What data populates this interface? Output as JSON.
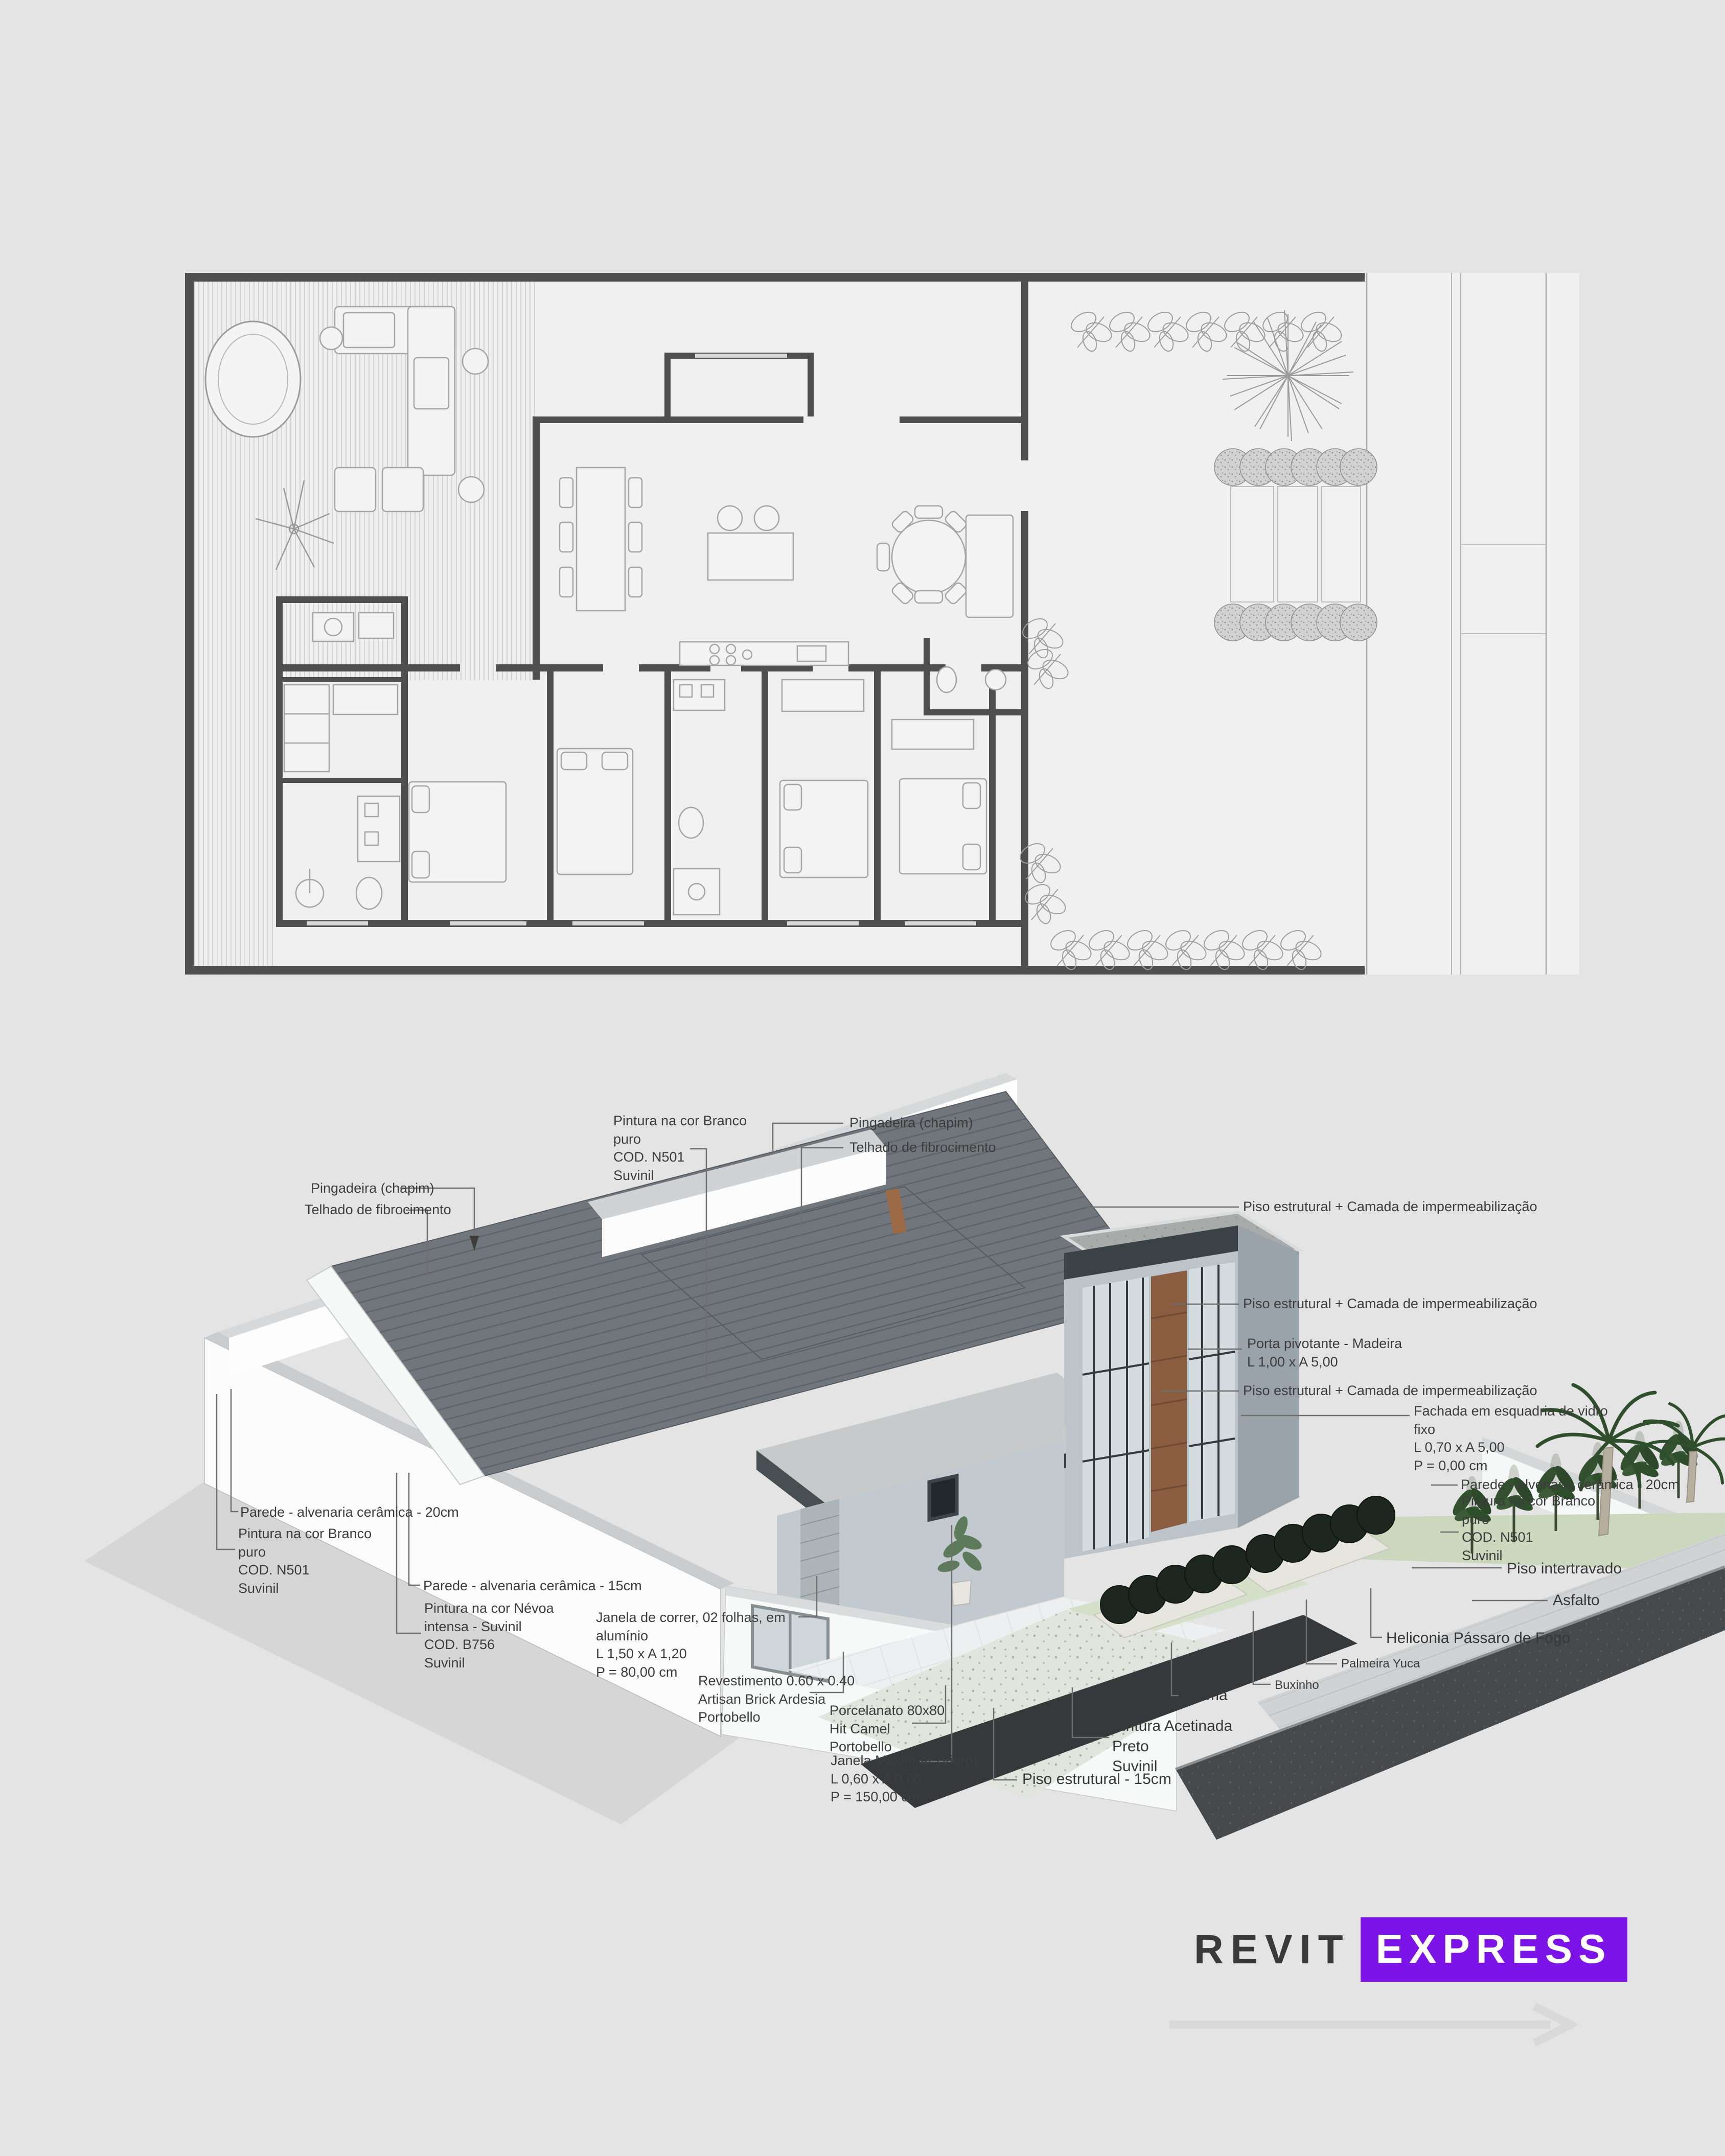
{
  "page": {
    "background": "#e4e4e4",
    "drawing_type": "architectural presentation sheet"
  },
  "annotations": {
    "pingadeira_left": [
      "Pingadeira (chapim)"
    ],
    "telhado_left": [
      "Telhado de fibrocimento"
    ],
    "pintura_branco_top": [
      "Pintura na cor Branco",
      "puro",
      "COD. N501",
      "Suvinil"
    ],
    "pingadeira_top": [
      "Pingadeira (chapim)"
    ],
    "telhado_top": [
      "Telhado de fibrocimento"
    ],
    "parede20_left": [
      "Parede - alvenaria cerâmica - 20cm"
    ],
    "pintura_branco_left": [
      "Pintura na cor Branco",
      "puro",
      "COD. N501",
      "Suvinil"
    ],
    "parede15": [
      "Parede - alvenaria cerâmica - 15cm"
    ],
    "pintura_nevoa": [
      "Pintura na cor Névoa",
      "intensa - Suvinil",
      "COD. B756",
      "Suvinil"
    ],
    "janela_correr": [
      "Janela de correr, 02 folhas, em",
      "alumínio",
      "L 1,50 x  A 1,20",
      "P = 80,00 cm"
    ],
    "revestimento": [
      "Revestimento 0.60 x 0.40",
      "Artisan Brick Ardesia",
      "Portobello"
    ],
    "porcelanato": [
      "Porcelanato 80x80",
      "Hit Camel",
      "Portobello"
    ],
    "janela_maxim": [
      "Janela Maxim-ar (Vidro)",
      "L 0,60 x  A 0,60",
      "P = 150,00 cm"
    ],
    "piso_estrutural_15": [
      "Piso estrutural - 15cm"
    ],
    "piso_imp_1": [
      "Piso estrutural + Camada de impermeabilização"
    ],
    "piso_imp_2": [
      "Piso estrutural + Camada de impermeabilização"
    ],
    "piso_imp_3": [
      "Piso estrutural + Camada de impermeabilização"
    ],
    "porta_pivotante": [
      "Porta pivotante - Madeira",
      "L 1,00 x  A 5,00"
    ],
    "fachada": [
      "Fachada em esquadria de vidro",
      "fixo",
      "L 0,70 x  A 5,00",
      "P = 0,00 cm"
    ],
    "parede20_right": [
      "Parede - alvenaria cerâmica - 20cm"
    ],
    "pintura_branco_right": [
      "Pintura na cor Branco",
      "puro",
      "COD. N501",
      "Suvinil"
    ],
    "piso_intertravado": [
      "Piso intertravado"
    ],
    "asfalto": [
      "Asfalto"
    ],
    "heliconia": [
      "Heliconia Pássaro de Fogo"
    ],
    "palmeira_yuca": [
      "Palmeira Yuca"
    ],
    "buxinho": [
      "Buxinho"
    ],
    "grama": [
      "Grama"
    ],
    "pintura_acetinada": [
      "Pintura Acetinada",
      "Preto",
      "Suvinil"
    ]
  },
  "logo": {
    "revit": "REVIT",
    "express": "EXPRESS",
    "purple": "#7c13e8",
    "dark": "#3a3a3a",
    "arrow_icon": "arrow-right"
  },
  "colors": {
    "plan_wall": "#4f4f4f",
    "roof_dark": "#70767b",
    "wall_blue_gray": "#bcc4ca",
    "wood_door": "#8a5c40",
    "fascia_dark": "#3a4245",
    "grass": "#d3dec6",
    "asphalt": "#45494c",
    "shadow": "#d6d6d6"
  }
}
